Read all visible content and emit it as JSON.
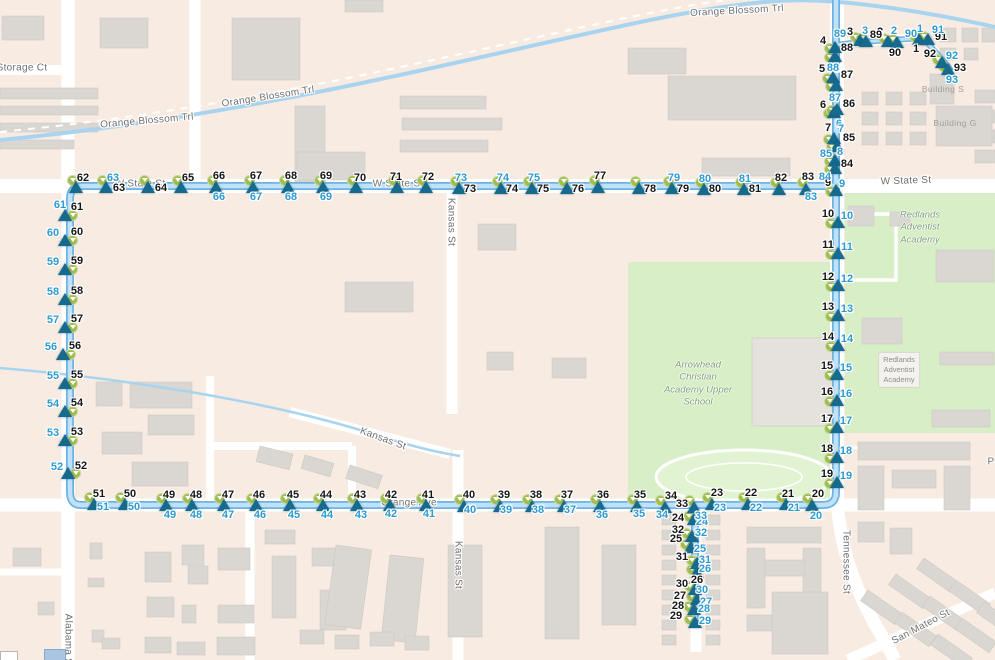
{
  "canvas": {
    "width": 995,
    "height": 660
  },
  "colors": {
    "background": "#f8ece2",
    "road": "#ffffff",
    "building": "#dad6d1",
    "campus_green": "#d7eec6",
    "water": "#a9d4ef",
    "route_outer": "#6fb2e2",
    "route_inner": "#bfe2f8",
    "stop_triangle": "#156a8e",
    "stop_circle": "#a0bd52",
    "stop_number_black": "#161616",
    "stop_number_blue": "#2d9ad2"
  },
  "street_labels": [
    {
      "text": "Storage Ct",
      "x": 22,
      "y": 68,
      "rot": 0
    },
    {
      "text": "Orange Blossom Trl",
      "x": 147,
      "y": 121,
      "rot": -5
    },
    {
      "text": "Orange Blossom Trl",
      "x": 268,
      "y": 97,
      "rot": -9
    },
    {
      "text": "Orange Blossom Trl",
      "x": 737,
      "y": 11,
      "rot": -3
    },
    {
      "text": "W State St",
      "x": 140,
      "y": 184,
      "rot": 0
    },
    {
      "text": "W State St",
      "x": 398,
      "y": 184,
      "rot": 0
    },
    {
      "text": "W State St",
      "x": 906,
      "y": 181,
      "rot": -2
    },
    {
      "text": "Orange Ave",
      "x": 409,
      "y": 503,
      "rot": 0
    },
    {
      "text": "Kansas St",
      "x": 451,
      "y": 222,
      "rot": 90
    },
    {
      "text": "Kansas St",
      "x": 383,
      "y": 439,
      "rot": 20
    },
    {
      "text": "Kansas St",
      "x": 458,
      "y": 565,
      "rot": 90
    },
    {
      "text": "Tennessee St",
      "x": 846,
      "y": 562,
      "rot": 90
    },
    {
      "text": "Alabama St",
      "x": 68,
      "y": 641,
      "rot": 90
    },
    {
      "text": "San Mateo St",
      "x": 921,
      "y": 627,
      "rot": -28
    },
    {
      "text": "P",
      "x": 991,
      "y": 462,
      "rot": 0
    }
  ],
  "place_labels": [
    {
      "lines": [
        "Redlands",
        "Adventist",
        "Academy"
      ],
      "x": 920,
      "y": 228,
      "style": "campus"
    },
    {
      "lines": [
        "Arrowhead",
        "Christian",
        "Academy Upper",
        "School"
      ],
      "x": 698,
      "y": 384,
      "style": "campus"
    },
    {
      "lines": [
        "Redlands",
        "Adventist",
        "Academy"
      ],
      "x": 899,
      "y": 370,
      "style": "boxed"
    },
    {
      "lines": [
        "Building S"
      ],
      "x": 943,
      "y": 89,
      "style": "bldg"
    },
    {
      "lines": [
        "Building G"
      ],
      "x": 955,
      "y": 123,
      "style": "bldg"
    }
  ],
  "stop_groups": {
    "L": {
      "circle": [
        7,
        0
      ],
      "black": [
        12,
        -8
      ],
      "blue": [
        -12,
        -7
      ]
    },
    "T": {
      "circle": [
        -4,
        -7
      ],
      "black": [
        3,
        -11
      ],
      "blue": [
        3,
        10
      ]
    },
    "R": {
      "circle": [
        -8,
        1
      ],
      "black": [
        -10,
        -8
      ],
      "blue": [
        9,
        -6
      ]
    },
    "RU": {
      "circle": [
        -6,
        1
      ],
      "black": [
        -12,
        -6
      ],
      "blue": [
        10,
        -6
      ]
    },
    "B": {
      "circle": [
        -5,
        -7
      ],
      "black": [
        1,
        -11
      ],
      "blue": [
        4,
        10
      ]
    },
    "BR": {
      "circle": [
        -6,
        -3
      ],
      "black": [
        -15,
        -4
      ],
      "blue": [
        9,
        1
      ]
    },
    "NE": {
      "circle": [
        -5,
        -3
      ],
      "black": [
        -12,
        -6
      ],
      "blue": [
        10,
        -6
      ]
    }
  },
  "stops": [
    [
      1,
      919,
      39,
      "NE",
      -3,
      10,
      1,
      -10
    ],
    [
      2,
      888,
      41,
      "NE",
      -8,
      -9,
      6,
      -10
    ],
    [
      3,
      860,
      40,
      "NE",
      -10,
      -8,
      5,
      -9
    ],
    [
      4,
      835,
      47,
      "RU",
      -12,
      -6,
      "n",
      "n"
    ],
    [
      5,
      833,
      77,
      "RU",
      -11,
      -8,
      4,
      -8
    ],
    [
      6,
      834,
      112,
      "RU",
      -11,
      -7,
      5,
      12
    ],
    [
      7,
      834,
      138,
      "RU",
      -6,
      -10,
      7,
      -9
    ],
    [
      8,
      835,
      160,
      "RU",
      "n",
      "n",
      5,
      -8
    ],
    [
      9,
      836,
      190,
      "RU",
      -8,
      -7,
      6,
      -6
    ],
    [
      10,
      838,
      222,
      "R",
      null,
      null,
      null,
      null
    ],
    [
      11,
      838,
      253,
      "R",
      null,
      null,
      null,
      null
    ],
    [
      12,
      838,
      285,
      "R",
      null,
      null,
      null,
      null
    ],
    [
      13,
      838,
      315,
      "R",
      null,
      null,
      null,
      null
    ],
    [
      14,
      838,
      345,
      "R",
      null,
      null,
      null,
      null
    ],
    [
      15,
      837,
      374,
      "R",
      null,
      null,
      null,
      null
    ],
    [
      16,
      837,
      400,
      "R",
      null,
      null,
      null,
      null
    ],
    [
      17,
      837,
      427,
      "R",
      null,
      null,
      null,
      null
    ],
    [
      18,
      837,
      457,
      "R",
      null,
      null,
      null,
      null
    ],
    [
      19,
      837,
      482,
      "R",
      null,
      null,
      null,
      null
    ],
    [
      20,
      812,
      505,
      "B",
      6,
      -11,
      4,
      11
    ],
    [
      21,
      786,
      504,
      "B",
      2,
      -10,
      8,
      4
    ],
    [
      22,
      748,
      504,
      "B",
      3,
      -11,
      8,
      4
    ],
    [
      23,
      712,
      504,
      "B",
      5,
      -11,
      8,
      4
    ],
    [
      24,
      694,
      519,
      "BR",
      -16,
      -1,
      8,
      3
    ],
    [
      25,
      691,
      547,
      "BR",
      -15,
      -8,
      9,
      2
    ],
    [
      26,
      697,
      572,
      "BR",
      0,
      8,
      8,
      -3
    ],
    [
      27,
      697,
      599,
      "BR",
      -17,
      -3,
      9,
      3
    ],
    [
      28,
      694,
      609,
      "BR",
      -16,
      -3,
      10,
      0
    ],
    [
      29,
      695,
      622,
      "BR",
      -19,
      -6,
      10,
      -1
    ],
    [
      30,
      695,
      589,
      "BR",
      -13,
      -5,
      7,
      1
    ],
    [
      31,
      697,
      563,
      "BR",
      -15,
      -6,
      8,
      -3
    ],
    [
      32,
      692,
      536,
      "BR",
      -14,
      -6,
      9,
      -3
    ],
    [
      33,
      694,
      507,
      "B",
      -12,
      -3,
      7,
      9
    ],
    [
      34,
      665,
      507,
      "B",
      6,
      -11,
      -3,
      8
    ],
    [
      35,
      637,
      506,
      "B",
      3,
      -11,
      2,
      8
    ],
    [
      36,
      600,
      506,
      "B",
      3,
      -11,
      2,
      9
    ],
    [
      37,
      564,
      506,
      "B",
      3,
      -11,
      6,
      4
    ],
    [
      38,
      532,
      506,
      "B",
      4,
      -11,
      6,
      4
    ],
    [
      39,
      500,
      506,
      "B",
      4,
      -11,
      6,
      4
    ],
    [
      40,
      464,
      506,
      "B",
      5,
      -11,
      6,
      4
    ],
    [
      41,
      426,
      505,
      "B",
      2,
      -10,
      3,
      9
    ],
    [
      42,
      390,
      505,
      "B",
      1,
      -10,
      1,
      9
    ],
    [
      43,
      357,
      505,
      "B",
      3,
      -10,
      null,
      null
    ],
    [
      44,
      323,
      505,
      "B",
      3,
      -10,
      null,
      null
    ],
    [
      45,
      290,
      505,
      "B",
      3,
      -10,
      null,
      null
    ],
    [
      46,
      256,
      505,
      "B",
      3,
      -10,
      null,
      null
    ],
    [
      47,
      224,
      505,
      "B",
      4,
      -10,
      null,
      null
    ],
    [
      48,
      192,
      505,
      "B",
      4,
      -10,
      null,
      null
    ],
    [
      49,
      166,
      505,
      "B",
      3,
      -10,
      null,
      null
    ],
    [
      50,
      125,
      504,
      "B",
      5,
      -10,
      9,
      3
    ],
    [
      51,
      94,
      504,
      "B",
      5,
      -10,
      9,
      3
    ],
    [
      52,
      68,
      473,
      "L",
      13,
      -7,
      -11,
      -6
    ],
    [
      53,
      65,
      440,
      "L",
      null,
      null,
      null,
      null
    ],
    [
      54,
      65,
      411,
      "L",
      null,
      null,
      null,
      null
    ],
    [
      55,
      65,
      383,
      "L",
      null,
      null,
      null,
      null
    ],
    [
      56,
      63,
      354,
      "L",
      null,
      null,
      null,
      null
    ],
    [
      57,
      65,
      327,
      "L",
      null,
      null,
      null,
      null
    ],
    [
      58,
      65,
      299,
      "L",
      null,
      null,
      null,
      null
    ],
    [
      59,
      65,
      269,
      "L",
      null,
      null,
      null,
      null
    ],
    [
      60,
      65,
      240,
      "L",
      null,
      null,
      null,
      null
    ],
    [
      61,
      65,
      215,
      "L",
      12,
      -8,
      -5,
      -10
    ],
    [
      62,
      76,
      187,
      "T",
      7,
      -9,
      "n",
      "n"
    ],
    [
      63,
      106,
      187,
      "T",
      13,
      1,
      7,
      -9
    ],
    [
      64,
      148,
      187,
      "T",
      13,
      1,
      "n",
      "n"
    ],
    [
      65,
      181,
      187,
      "T",
      7,
      -9,
      "n",
      "n"
    ],
    [
      66,
      216,
      187,
      "T",
      null,
      null,
      null,
      null
    ],
    [
      67,
      253,
      187,
      "T",
      null,
      null,
      null,
      null
    ],
    [
      68,
      288,
      187,
      "T",
      null,
      null,
      null,
      null
    ],
    [
      69,
      323,
      187,
      "T",
      null,
      null,
      null,
      null
    ],
    [
      70,
      356,
      187,
      "T",
      4,
      -9,
      "n",
      "n"
    ],
    [
      71,
      397,
      187,
      "T",
      -1,
      -10,
      "n",
      "n"
    ],
    [
      72,
      426,
      187,
      "T",
      2,
      -10,
      "n",
      "n"
    ],
    [
      73,
      459,
      188,
      "T",
      11,
      1,
      2,
      -10
    ],
    [
      74,
      501,
      188,
      "T",
      11,
      1,
      2,
      -10
    ],
    [
      75,
      532,
      188,
      "T",
      11,
      1,
      2,
      -10
    ],
    [
      76,
      567,
      188,
      "T",
      11,
      1,
      "n",
      "n"
    ],
    [
      77,
      598,
      187,
      "T",
      2,
      -11,
      "n",
      "n"
    ],
    [
      78,
      639,
      188,
      "T",
      11,
      1,
      "n",
      "n"
    ],
    [
      79,
      672,
      188,
      "T",
      11,
      1,
      2,
      -10
    ],
    [
      80,
      704,
      189,
      "T",
      11,
      0,
      1,
      -10
    ],
    [
      81,
      744,
      189,
      "T",
      11,
      0,
      1,
      -10
    ],
    [
      82,
      779,
      189,
      "T",
      2,
      -11,
      "n",
      "n"
    ],
    [
      83,
      806,
      189,
      "T",
      2,
      -12,
      5,
      8
    ],
    [
      84,
      835,
      168,
      "RU",
      12,
      -4,
      -10,
      9
    ],
    [
      85,
      837,
      146,
      "RU",
      12,
      -8,
      -11,
      8
    ],
    [
      86,
      837,
      109,
      "RU",
      12,
      -5,
      "n",
      "n"
    ],
    [
      87,
      836,
      85,
      "RU",
      11,
      -10,
      -1,
      13
    ],
    [
      88,
      835,
      56,
      "RU",
      12,
      -8,
      -2,
      12
    ],
    [
      89,
      866,
      41,
      "NE",
      10,
      -6,
      -26,
      -7
    ],
    [
      90,
      897,
      42,
      "NE",
      -2,
      11,
      14,
      -8
    ],
    [
      91,
      928,
      39,
      "NE",
      13,
      -2,
      10,
      -9
    ],
    [
      92,
      942,
      62,
      "NE",
      -12,
      -8,
      10,
      -6
    ],
    [
      93,
      948,
      69,
      "NE",
      12,
      -1,
      4,
      11
    ]
  ]
}
